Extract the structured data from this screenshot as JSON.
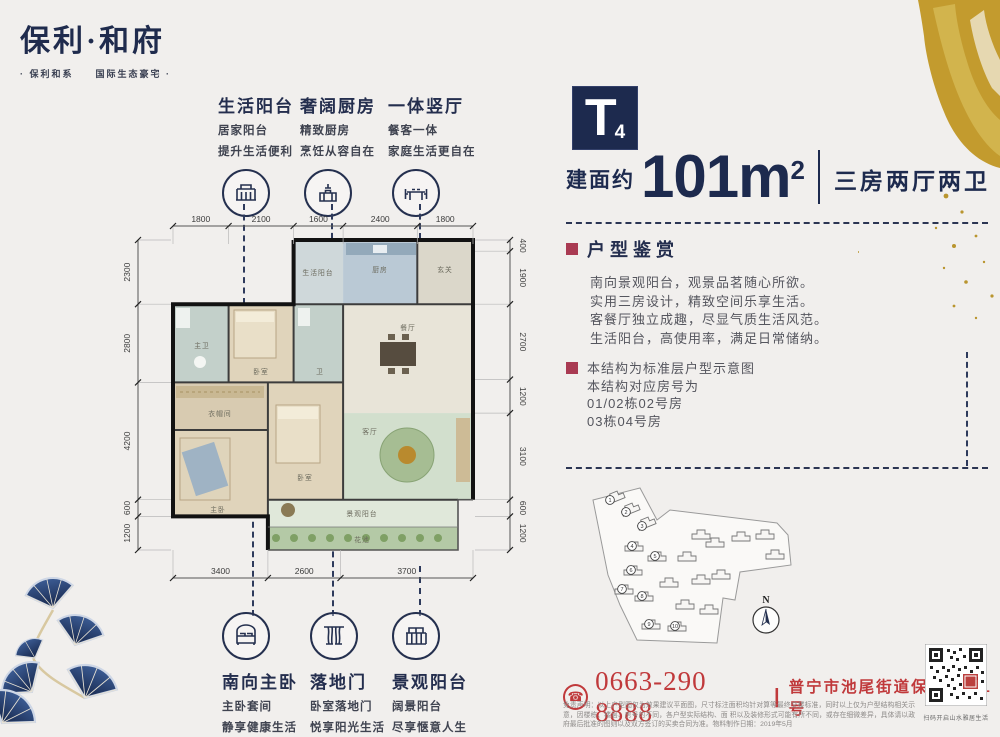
{
  "brand": {
    "name": "保利·和府",
    "tagline": "· 保利和系　　国际生态豪宅 ·"
  },
  "top_features": [
    {
      "title": "生活阳台",
      "line1": "居家阳台",
      "line2": "提升生活便利"
    },
    {
      "title": "奢阔厨房",
      "line1": "精致厨房",
      "line2": "烹饪从容自在"
    },
    {
      "title": "一体竖厅",
      "line1": "餐客一体",
      "line2": "家庭生活更自在"
    }
  ],
  "bottom_features": [
    {
      "title": "南向主卧",
      "line1": "主卧套间",
      "line2": "静享健康生活"
    },
    {
      "title": "落地门",
      "line1": "卧室落地门",
      "line2": "悦享阳光生活"
    },
    {
      "title": "景观阳台",
      "line1": "阔景阳台",
      "line2": "尽享惬意人生"
    }
  ],
  "unit": {
    "type_letter": "T",
    "type_number": "4",
    "area_prefix": "建面约",
    "area_value": "101m",
    "area_sup": "2",
    "layout": "三房两厅两卫"
  },
  "appreciation": {
    "title": "户型鉴赏",
    "lines": [
      "南向景观阳台，观景品茗随心所欲。",
      "实用三房设计，精致空间乐享生活。",
      "客餐厅独立成趣，尽显气质生活风范。",
      "生活阳台，高使用率，满足日常储纳。"
    ]
  },
  "structure_note": {
    "lines": [
      "本结构为标准层户型示意图",
      "本结构对应房号为",
      "01/02栋02号房",
      "03栋04号房"
    ]
  },
  "floorplan": {
    "dims_top": [
      "1800",
      "2100",
      "1600",
      "2400",
      "1800"
    ],
    "dims_left": [
      "2300",
      "2800",
      "4200",
      "600",
      "1200"
    ],
    "dims_right": [
      "400",
      "1900",
      "2700",
      "1200",
      "3100",
      "600",
      "1200"
    ],
    "dims_bottom": [
      "3400",
      "2600",
      "3700"
    ],
    "rooms": [
      "生活阳台",
      "厨房",
      "玄关",
      "餐厅",
      "客厅",
      "主卫",
      "卧室",
      "卫",
      "衣帽间",
      "主卧",
      "卧室",
      "景观阳台",
      "花池"
    ]
  },
  "siteplan": {
    "compass": "N",
    "markers": [
      "1",
      "2",
      "3",
      "4",
      "5",
      "6",
      "7",
      "8",
      "9",
      "10"
    ]
  },
  "contact": {
    "phone": "0663-290 8888",
    "separator": "|",
    "address": "普宁市池尾街道保利大道1号"
  },
  "disclaimer": {
    "line1": "免责声明：以上户型图仅为效果建议平面图，尺寸标注面积均针对算等最终交楼标准，同时以上仅为户型结构相关示意，因楼栋、楼层、房号的不同，各户型实际结构、面",
    "line2": "积以及装修形式可能有所不同，或存在细微差异，具体请以政府最后批准的图则以及双方签订的买卖合同为准。物料制作日期：2019年5月"
  },
  "qr": {
    "caption": "扫码开启山水雅居生活"
  },
  "colors": {
    "navy": "#1d2a4e",
    "accent_red": "#a93a52",
    "contact_red": "#c0393b",
    "gold": "#c39b2e"
  }
}
